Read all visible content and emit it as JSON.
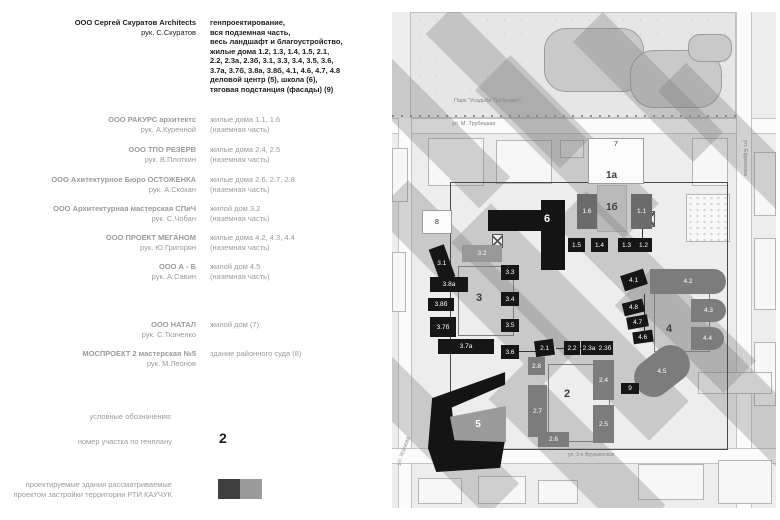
{
  "credits": {
    "entries": [
      {
        "firm": "ООО Сергей Скуратов Architects",
        "head": "рук. С.Скуратов",
        "primary": true,
        "top": 18,
        "scope": [
          "генпроектирование,",
          "вся подземная часть,",
          "весь ландшафт и благоустройство,",
          "жилые дома 1.2, 1.3, 1.4, 1.5, 2.1,",
          "2.2, 2.3а, 2.3б, 3.1, 3.3, 3.4, 3.5, 3.6,",
          "3.7а, 3.7б, 3.8а, 3.8б, 4.1, 4.6, 4.7, 4.8",
          "деловой центр (5),  школа (6),",
          "тяговая подстанция (фасады) (9)"
        ]
      },
      {
        "firm": "ООО  РАКУРС архитектс",
        "head": "рук. А.Куренной",
        "top": 115,
        "scope": [
          "жилые дома  1.1, 1.6",
          "(наземная часть)"
        ]
      },
      {
        "firm": "ООО  ТПО РЕЗЕРВ",
        "head": "рук. В.Плоткин",
        "top": 145,
        "scope": [
          "жилые дома  2.4, 2.5",
          "(наземная часть)"
        ]
      },
      {
        "firm": "ООО  Ахитектурное Бюро ОСТОЖЕНКА",
        "head": "рук. А.Скокан",
        "top": 175,
        "scope": [
          "жилые дома  2.6, 2.7, 2.8",
          "(наземная часть)"
        ]
      },
      {
        "firm": "ООО  Архитектурная мастерская СПиЧ",
        "head": "рук. С.Чобан",
        "top": 204,
        "scope": [
          "жилой дом  3.2",
          "(наземная часть)"
        ]
      },
      {
        "firm": "ООО  ПРОЕКТ МЕГАНОМ",
        "head": "рук. Ю.Григорян",
        "top": 233,
        "scope": [
          "жилые дома  4.2, 4.3, 4.4",
          "(наземная часть)"
        ]
      },
      {
        "firm": "ООО  А - Б",
        "head": "рук. А.Савин",
        "top": 262,
        "scope": [
          "жилой дом  4.5",
          "(наземная часть)"
        ]
      },
      {
        "firm": "ООО  НАТАЛ",
        "head": "рук. С.Ткаченко",
        "top": 320,
        "scope": [
          "жилой дом (7)"
        ]
      },
      {
        "firm": "МОСПРОЕКТ 2   мастерская №5",
        "head": "рук. М.Леонов",
        "top": 349,
        "scope": [
          "здание районного суда (8)"
        ]
      }
    ],
    "legend_heading": "условные обозначения:",
    "plot_number_label": "номер участка по генплану",
    "plot_number_value": "2",
    "note_lines": [
      "проектируемые здания рассматриваемые",
      "проектом застройки территории РТИ КАУЧУК"
    ],
    "swatches": [
      "#3f3f3f",
      "#9b9b9b"
    ]
  },
  "map": {
    "park_label": "Парк \"Усадьба Трубецких\"",
    "street_top": "ул. М. Трубецкая",
    "street_right": "ул. Ефремова",
    "street_left": "ул. Усачева",
    "street_bottom": "ул. 3-я Фрунзенская",
    "shape5_label": "5",
    "shape6_label": "6",
    "area_labels": [
      {
        "text": "1а",
        "x": 214,
        "y": 158,
        "size": 10
      },
      {
        "text": "1б",
        "x": 214,
        "y": 190,
        "size": 10
      },
      {
        "text": "3",
        "x": 84,
        "y": 280,
        "size": 11
      },
      {
        "text": "2",
        "x": 172,
        "y": 376,
        "size": 11
      },
      {
        "text": "4",
        "x": 274,
        "y": 311,
        "size": 11
      }
    ],
    "white_buildings": [
      {
        "label": "7",
        "x": 196,
        "y": 126,
        "w": 56,
        "h": 46,
        "labelTop": true
      },
      {
        "label": "8",
        "x": 30,
        "y": 198,
        "w": 30,
        "h": 24,
        "labelTop": false
      }
    ],
    "blocks": [
      {
        "label": "3.1",
        "x": 42,
        "y": 234,
        "w": 16,
        "h": 34,
        "kind": "black",
        "rot": -20
      },
      {
        "label": "3.2",
        "x": 70,
        "y": 233,
        "w": 40,
        "h": 17,
        "kind": "graylight",
        "rot": 0
      },
      {
        "label": "3.3",
        "x": 109,
        "y": 253,
        "w": 18,
        "h": 15,
        "kind": "black",
        "rot": 0
      },
      {
        "label": "3.4",
        "x": 109,
        "y": 280,
        "w": 18,
        "h": 14,
        "kind": "black",
        "rot": 0
      },
      {
        "label": "3.5",
        "x": 109,
        "y": 307,
        "w": 18,
        "h": 13,
        "kind": "black",
        "rot": 0
      },
      {
        "label": "3.6",
        "x": 109,
        "y": 333,
        "w": 18,
        "h": 14,
        "kind": "black",
        "rot": 0
      },
      {
        "label": "3.8а",
        "x": 38,
        "y": 265,
        "w": 38,
        "h": 15,
        "kind": "black",
        "rot": 0
      },
      {
        "label": "3.8б",
        "x": 36,
        "y": 286,
        "w": 26,
        "h": 13,
        "kind": "black",
        "rot": 0
      },
      {
        "label": "3.7б",
        "x": 38,
        "y": 305,
        "w": 26,
        "h": 20,
        "kind": "black",
        "rot": 0
      },
      {
        "label": "3.7а",
        "x": 46,
        "y": 327,
        "w": 56,
        "h": 15,
        "kind": "black",
        "rot": 0
      },
      {
        "label": "2.1",
        "x": 143,
        "y": 328,
        "w": 19,
        "h": 16,
        "kind": "black",
        "rot": -8
      },
      {
        "label": "2.2",
        "x": 172,
        "y": 329,
        "w": 16,
        "h": 14,
        "kind": "black",
        "rot": 0
      },
      {
        "label": "2.3а",
        "x": 189,
        "y": 329,
        "w": 16,
        "h": 14,
        "kind": "black",
        "rot": 0
      },
      {
        "label": "2.3б",
        "x": 205,
        "y": 329,
        "w": 16,
        "h": 14,
        "kind": "black",
        "rot": 0
      },
      {
        "label": "1.5",
        "x": 176,
        "y": 226,
        "w": 17,
        "h": 14,
        "kind": "black",
        "rot": 0
      },
      {
        "label": "1.4",
        "x": 199,
        "y": 226,
        "w": 17,
        "h": 14,
        "kind": "black",
        "rot": 0
      },
      {
        "label": "1.3",
        "x": 226,
        "y": 226,
        "w": 17,
        "h": 14,
        "kind": "black",
        "rot": 0
      },
      {
        "label": "1.2",
        "x": 243,
        "y": 226,
        "w": 17,
        "h": 14,
        "kind": "black",
        "rot": 0
      },
      {
        "label": "1.6",
        "x": 185,
        "y": 182,
        "w": 20,
        "h": 35,
        "kind": "graydark",
        "rot": 0
      },
      {
        "label": "1.1",
        "x": 239,
        "y": 182,
        "w": 21,
        "h": 35,
        "kind": "graydark",
        "rot": 0
      },
      {
        "label": "4.1",
        "x": 230,
        "y": 260,
        "w": 24,
        "h": 16,
        "kind": "black",
        "rot": -18
      },
      {
        "label": "4.8",
        "x": 231,
        "y": 289,
        "w": 21,
        "h": 13,
        "kind": "black",
        "rot": -14
      },
      {
        "label": "4.7",
        "x": 235,
        "y": 304,
        "w": 21,
        "h": 12,
        "kind": "black",
        "rot": -10
      },
      {
        "label": "4.6",
        "x": 241,
        "y": 319,
        "w": 20,
        "h": 12,
        "kind": "black",
        "rot": -8
      },
      {
        "label": "4.2",
        "x": 258,
        "y": 257,
        "w": 76,
        "h": 25,
        "kind": "grayround",
        "rot": 0
      },
      {
        "label": "4.3",
        "x": 299,
        "y": 287,
        "w": 35,
        "h": 23,
        "kind": "grayround",
        "rot": 0
      },
      {
        "label": "4.4",
        "x": 299,
        "y": 315,
        "w": 33,
        "h": 23,
        "kind": "grayround",
        "rot": 0
      },
      {
        "label": "4.5",
        "x": 240,
        "y": 340,
        "w": 60,
        "h": 38,
        "kind": "blob",
        "rot": -38
      },
      {
        "label": "9",
        "x": 229,
        "y": 371,
        "w": 18,
        "h": 11,
        "kind": "black",
        "rot": 0
      },
      {
        "label": "2.8",
        "x": 136,
        "y": 345,
        "w": 17,
        "h": 18,
        "kind": "gray",
        "rot": 0
      },
      {
        "label": "2.7",
        "x": 136,
        "y": 373,
        "w": 19,
        "h": 52,
        "kind": "gray",
        "rot": 0
      },
      {
        "label": "2.4",
        "x": 201,
        "y": 348,
        "w": 21,
        "h": 40,
        "kind": "gray",
        "rot": 0
      },
      {
        "label": "2.5",
        "x": 201,
        "y": 393,
        "w": 21,
        "h": 38,
        "kind": "gray",
        "rot": 0
      },
      {
        "label": "2.6",
        "x": 146,
        "y": 420,
        "w": 31,
        "h": 15,
        "kind": "gray",
        "rot": 0
      }
    ]
  }
}
